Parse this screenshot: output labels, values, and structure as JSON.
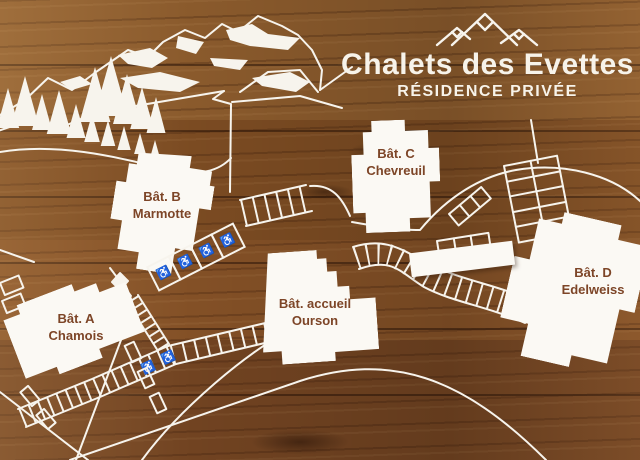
{
  "sign": {
    "title": "Chalets des Evettes",
    "subtitle": "RÉSIDENCE PRIVÉE"
  },
  "buildings": [
    {
      "id": "a",
      "name": "Bât. A",
      "subname": "Chamois"
    },
    {
      "id": "b",
      "name": "Bât. B",
      "subname": "Marmotte"
    },
    {
      "id": "c",
      "name": "Bât. C",
      "subname": "Chevreuil"
    },
    {
      "id": "accueil",
      "name": "Bât. accueil",
      "subname": "Ourson"
    },
    {
      "id": "d",
      "name": "Bât. D",
      "subname": "Edelweiss"
    }
  ],
  "icons": {
    "wheelchair": "♿",
    "mountain_logo": "three-peaks",
    "accessible_parking_count": 6
  },
  "colors": {
    "wood_base": "#7a4a22",
    "line_white": "#f7f4ed",
    "label_brown": "#7d4527"
  }
}
